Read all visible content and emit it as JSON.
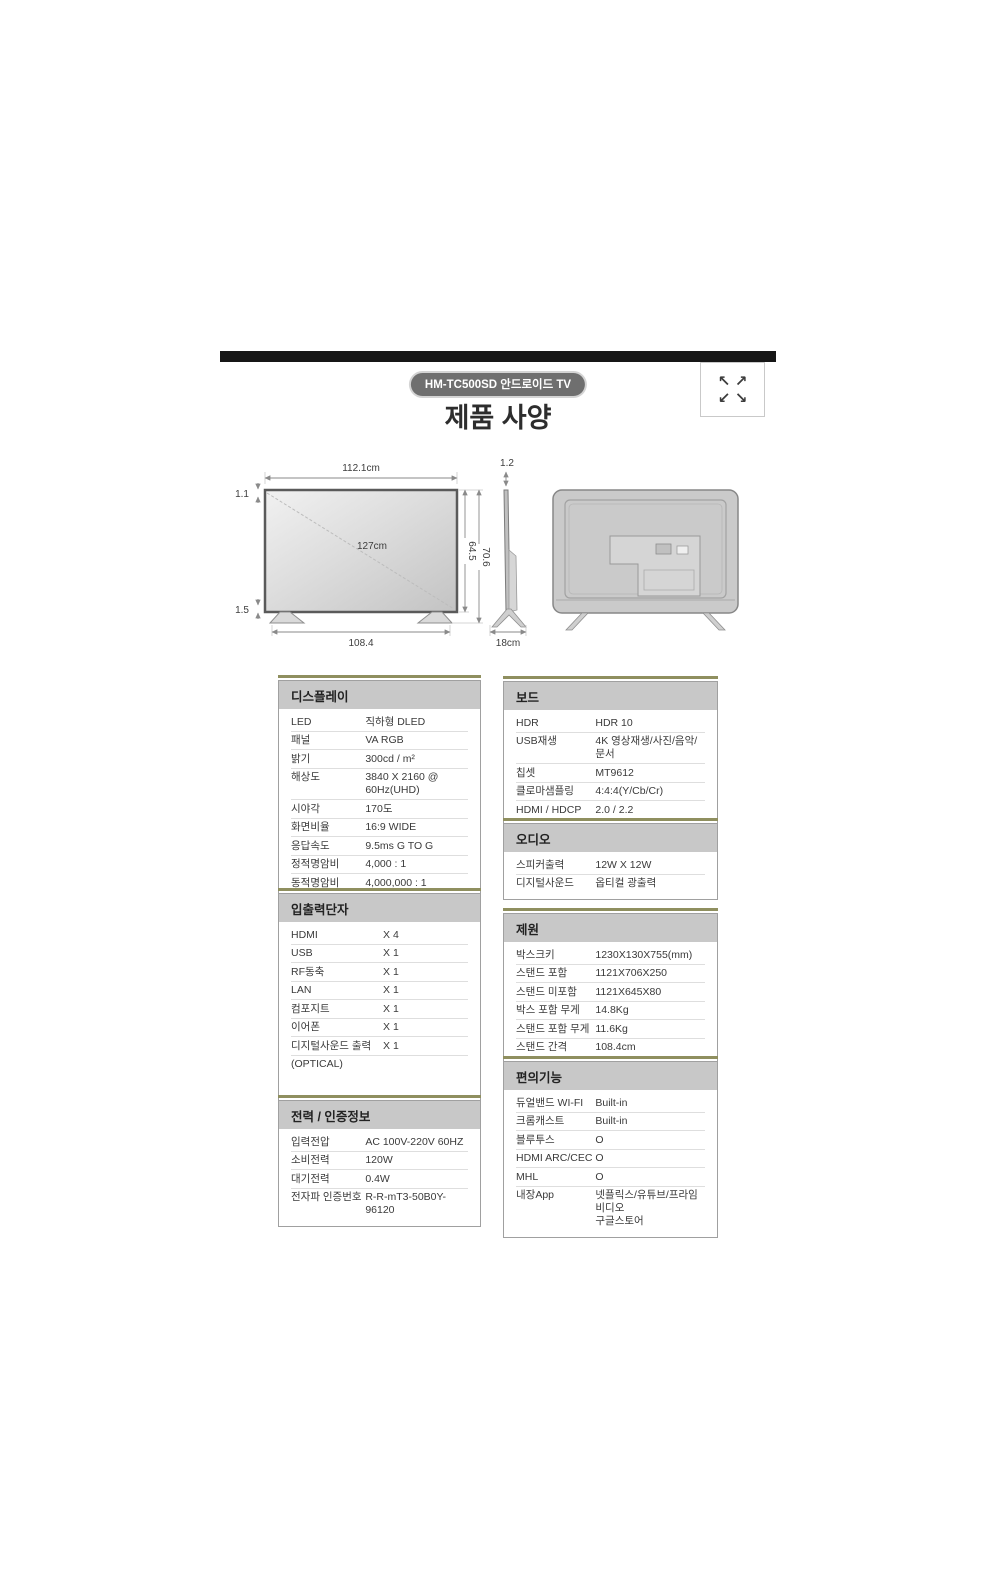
{
  "header": {
    "badge": "HM-TC500SD 안드로이드 TV",
    "title": "제품 사양"
  },
  "icons": {
    "expand_nw": "↖",
    "expand_ne": "↗",
    "expand_sw": "↙",
    "expand_se": "↘"
  },
  "diagram": {
    "front": {
      "width_label": "112.1cm",
      "top_bezel_label": "1.1",
      "diagonal_label": "127cm",
      "panel_height_label": "64.5",
      "total_height_label": "70.6",
      "bottom_bezel_label": "1.5",
      "stand_width_label": "108.4"
    },
    "side": {
      "thickness_label": "1.2",
      "depth_label": "18cm"
    }
  },
  "tables": [
    {
      "id": "display",
      "title": "디스플레이",
      "rows": [
        [
          "LED",
          "직하형 DLED"
        ],
        [
          "패널",
          "VA RGB"
        ],
        [
          "밝기",
          "300cd / m²"
        ],
        [
          "해상도",
          "3840 X 2160 @ 60Hz(UHD)"
        ],
        [
          "시야각",
          "170도"
        ],
        [
          "화면비율",
          "16:9 WIDE"
        ],
        [
          "응답속도",
          "9.5ms G TO G"
        ],
        [
          "정적명암비",
          "4,000 : 1"
        ],
        [
          "동적명암비",
          "4,000,000 : 1"
        ]
      ]
    },
    {
      "id": "io",
      "title": "입출력단자",
      "rows": [
        [
          "HDMI",
          "X 4"
        ],
        [
          "USB",
          "X 1"
        ],
        [
          "RF동축",
          "X 1"
        ],
        [
          "LAN",
          "X 1"
        ],
        [
          "컴포지트",
          "X 1"
        ],
        [
          "이어폰",
          "X 1"
        ],
        [
          "디지털사운드 출력",
          "X 1"
        ],
        [
          "(OPTICAL)",
          ""
        ]
      ]
    },
    {
      "id": "power",
      "title": "전력 / 인증정보",
      "rows": [
        [
          "입력전압",
          "AC 100V-220V 60HZ"
        ],
        [
          "소비전력",
          "120W"
        ],
        [
          "대기전력",
          "0.4W"
        ],
        [
          "전자파 인증번호",
          "R-R-mT3-50B0Y-96120"
        ]
      ]
    },
    {
      "id": "board",
      "title": "보드",
      "rows": [
        [
          "HDR",
          "HDR 10"
        ],
        [
          "USB재생",
          "4K 영상재생/사진/음악/문서"
        ],
        [
          "칩셋",
          "MT9612"
        ],
        [
          "클로마샘플링",
          "4:4:4(Y/Cb/Cr)"
        ],
        [
          "HDMI / HDCP",
          "2.0 / 2.2"
        ]
      ]
    },
    {
      "id": "audio",
      "title": "오디오",
      "rows": [
        [
          "스피커출력",
          "12W X 12W"
        ],
        [
          "디지털사운드",
          "옵티컬 광출력"
        ]
      ]
    },
    {
      "id": "dimensions",
      "title": "제원",
      "rows": [
        [
          "박스크키",
          "1230X130X755(mm)"
        ],
        [
          "스탠드 포함",
          "1121X706X250"
        ],
        [
          "스탠드 미포함",
          "1121X645X80"
        ],
        [
          "박스 포함 무게",
          "14.8Kg"
        ],
        [
          "스탠드 포함 무게",
          "11.6Kg"
        ],
        [
          "스탠드 간격",
          "108.4cm"
        ]
      ]
    },
    {
      "id": "features",
      "title": "편의기능",
      "rows": [
        [
          "듀얼밴드 WI-FI",
          "Built-in"
        ],
        [
          "크롬캐스트",
          "Built-in"
        ],
        [
          "블루투스",
          "O"
        ],
        [
          "HDMI ARC/CEC",
          "O"
        ],
        [
          "MHL",
          "O"
        ],
        [
          "내장App",
          "넷플릭스/유튜브/프라임비디오\n구글스토어"
        ]
      ]
    }
  ],
  "colors": {
    "accent_olive": "#8f8f5f",
    "header_gray": "#c8c8c8",
    "badge_gray": "#6f6f6f",
    "bar_black": "#161616"
  }
}
